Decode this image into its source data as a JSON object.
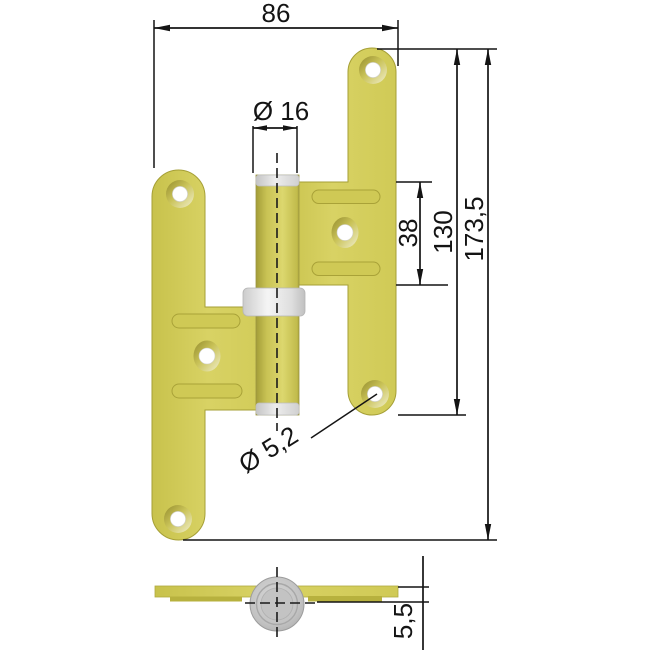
{
  "drawing": {
    "title": "Door hinge technical drawing, front and bottom views",
    "dims": {
      "overall_width": "86",
      "pin_diameter": "Ø 16",
      "slot_span": "38",
      "leaf_height": "130",
      "total_height": "173,5",
      "screw_hole_diameter": "Ø 5,2",
      "leaf_thickness": "5,5"
    },
    "colors": {
      "brass": "#d5cf5e",
      "brass_dark": "#a59f36",
      "steel_gray": "#d9d9d9",
      "line": "#141414",
      "background": "#ffffff"
    }
  }
}
